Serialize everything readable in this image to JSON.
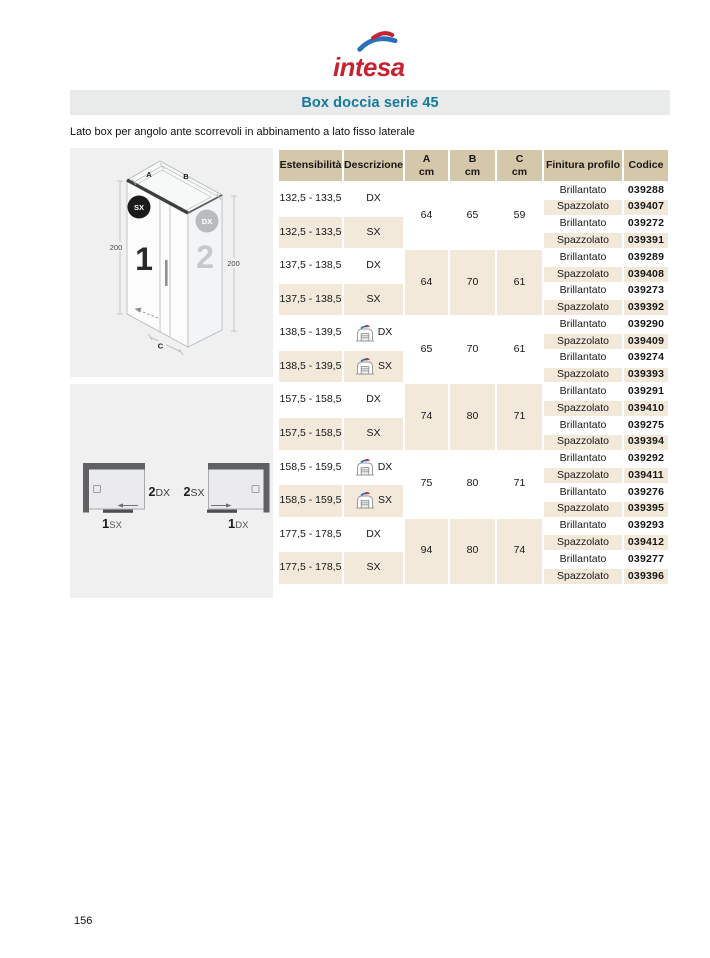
{
  "theme": {
    "brand_red": "#c42430",
    "brand_blue": "#2a6fb7",
    "title_teal": "#147a9d",
    "bar_gray": "#e9eaea",
    "header_beige": "#d5c7a9",
    "row_beige": "#f2e9db",
    "panel_gray": "#f0f0f1"
  },
  "brand": {
    "wordmark": "intesa"
  },
  "header": {
    "title": "Box doccia serie 45"
  },
  "subtitle": "Lato box per angolo ante scorrevoli in abbinamento a lato fisso laterale",
  "iso_diagram": {
    "dim_a": "A",
    "dim_b": "B",
    "dim_c": "C",
    "height_left": "200",
    "height_right": "200",
    "panel_1": "1",
    "panel_2": "2",
    "badge_left": "SX",
    "badge_right": "DX"
  },
  "plan_diagram": {
    "left": {
      "side_num": "2",
      "side_dir": "DX",
      "front_num": "1",
      "front_dir": "SX"
    },
    "right": {
      "side_num": "2",
      "side_dir": "SX",
      "front_num": "1",
      "front_dir": "DX"
    }
  },
  "table": {
    "columns": [
      {
        "label": "Estensibilità"
      },
      {
        "label": "Descrizione"
      },
      {
        "label": "A",
        "unit": "cm"
      },
      {
        "label": "B",
        "unit": "cm"
      },
      {
        "label": "C",
        "unit": "cm"
      },
      {
        "label": "Finitura profilo"
      },
      {
        "label": "Codice"
      }
    ],
    "groups": [
      {
        "a": "64",
        "b": "65",
        "c": "59",
        "rows": [
          {
            "est": "132,5 - 133,5",
            "desc": "DX",
            "icon": false,
            "finiture": [
              {
                "fin": "Brillantato",
                "cod": "039288"
              },
              {
                "fin": "Spazzolato",
                "cod": "039407"
              }
            ]
          },
          {
            "est": "132,5 - 133,5",
            "desc": "SX",
            "icon": false,
            "finiture": [
              {
                "fin": "Brillantato",
                "cod": "039272"
              },
              {
                "fin": "Spazzolato",
                "cod": "039391"
              }
            ]
          }
        ]
      },
      {
        "a": "64",
        "b": "70",
        "c": "61",
        "rows": [
          {
            "est": "137,5 - 138,5",
            "desc": "DX",
            "icon": false,
            "finiture": [
              {
                "fin": "Brillantato",
                "cod": "039289"
              },
              {
                "fin": "Spazzolato",
                "cod": "039408"
              }
            ]
          },
          {
            "est": "137,5 - 138,5",
            "desc": "SX",
            "icon": false,
            "finiture": [
              {
                "fin": "Brillantato",
                "cod": "039273"
              },
              {
                "fin": "Spazzolato",
                "cod": "039392"
              }
            ]
          }
        ]
      },
      {
        "a": "65",
        "b": "70",
        "c": "61",
        "rows": [
          {
            "est": "138,5 - 139,5",
            "desc": "DX",
            "icon": true,
            "finiture": [
              {
                "fin": "Brillantato",
                "cod": "039290"
              },
              {
                "fin": "Spazzolato",
                "cod": "039409"
              }
            ]
          },
          {
            "est": "138,5 - 139,5",
            "desc": "SX",
            "icon": true,
            "finiture": [
              {
                "fin": "Brillantato",
                "cod": "039274"
              },
              {
                "fin": "Spazzolato",
                "cod": "039393"
              }
            ]
          }
        ]
      },
      {
        "a": "74",
        "b": "80",
        "c": "71",
        "rows": [
          {
            "est": "157,5 - 158,5",
            "desc": "DX",
            "icon": false,
            "finiture": [
              {
                "fin": "Brillantato",
                "cod": "039291"
              },
              {
                "fin": "Spazzolato",
                "cod": "039410"
              }
            ]
          },
          {
            "est": "157,5 - 158,5",
            "desc": "SX",
            "icon": false,
            "finiture": [
              {
                "fin": "Brillantato",
                "cod": "039275"
              },
              {
                "fin": "Spazzolato",
                "cod": "039394"
              }
            ]
          }
        ]
      },
      {
        "a": "75",
        "b": "80",
        "c": "71",
        "rows": [
          {
            "est": "158,5 - 159,5",
            "desc": "DX",
            "icon": true,
            "finiture": [
              {
                "fin": "Brillantato",
                "cod": "039292"
              },
              {
                "fin": "Spazzolato",
                "cod": "039411"
              }
            ]
          },
          {
            "est": "158,5 - 159,5",
            "desc": "SX",
            "icon": true,
            "finiture": [
              {
                "fin": "Brillantato",
                "cod": "039276"
              },
              {
                "fin": "Spazzolato",
                "cod": "039395"
              }
            ]
          }
        ]
      },
      {
        "a": "94",
        "b": "80",
        "c": "74",
        "rows": [
          {
            "est": "177,5 - 178,5",
            "desc": "DX",
            "icon": false,
            "finiture": [
              {
                "fin": "Brillantato",
                "cod": "039293"
              },
              {
                "fin": "Spazzolato",
                "cod": "039412"
              }
            ]
          },
          {
            "est": "177,5 - 178,5",
            "desc": "SX",
            "icon": false,
            "finiture": [
              {
                "fin": "Brillantato",
                "cod": "039277"
              },
              {
                "fin": "Spazzolato",
                "cod": "039396"
              }
            ]
          }
        ]
      }
    ]
  },
  "footer": {
    "page_number": "156"
  }
}
